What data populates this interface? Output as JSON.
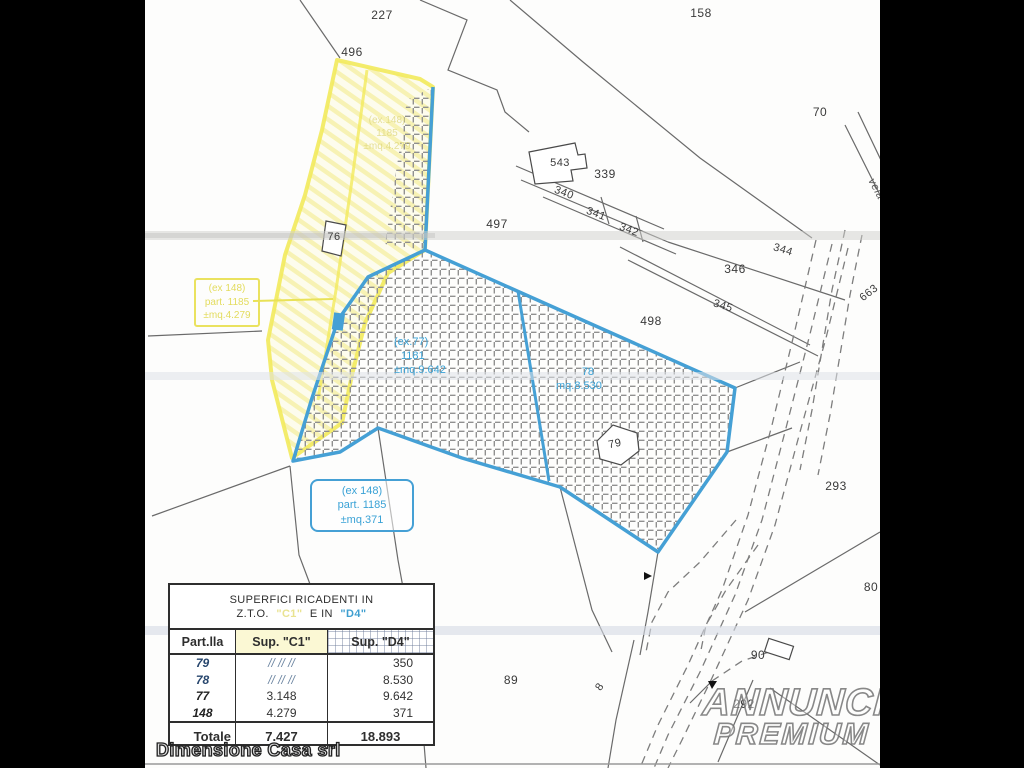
{
  "parcels": {
    "n227": "227",
    "n496": "496",
    "n158": "158",
    "n70": "70",
    "n497": "497",
    "n543": "543",
    "n339": "339",
    "n340": "340",
    "n341": "341",
    "n342": "342",
    "n344": "344",
    "n346": "346",
    "n345": "345",
    "n498": "498",
    "n663": "663",
    "n293": "293",
    "n80": "80",
    "n90": "90",
    "n89": "89",
    "n292": "292",
    "n8": "8",
    "n76": "76",
    "n79": "79",
    "road_name": "vela"
  },
  "annotations": {
    "ex77": {
      "line1": "(ex.77)",
      "line2": "1181",
      "line3": "±mq.9.642"
    },
    "p78": {
      "line1": "78",
      "line2": "mq.8.530"
    },
    "ex148_blue": {
      "line1": "(ex 148)",
      "line2": "part. 1185",
      "line3": "±mq.371"
    },
    "ex148_yellow": {
      "line1": "(ex 148)",
      "line2": "part. 1185",
      "line3": "±mq.4.279"
    },
    "ex148_faint": {
      "line1": "(ex.148)",
      "line2": "1185",
      "line3": "±mq.4.279"
    }
  },
  "table": {
    "title_line1": "SUPERFICI RICADENTI IN",
    "title_zto": "Z.T.O.",
    "title_c1": "\"C1\"",
    "title_ein": "E IN",
    "title_d4": "\"D4\"",
    "headers": [
      "Part.lla",
      "Sup. \"C1\"",
      "Sup. \"D4\""
    ],
    "rows": [
      {
        "part": "79",
        "c1": "//  //  //",
        "d4": "350"
      },
      {
        "part": "78",
        "c1": "//  //  //",
        "d4": "8.530"
      },
      {
        "part": "77",
        "c1": "3.148",
        "d4": "9.642"
      },
      {
        "part": "148",
        "c1": "4.279",
        "d4": "371"
      }
    ],
    "total": {
      "label": "Totale",
      "c1": "7.427",
      "d4": "18.893"
    }
  },
  "footer": {
    "company": "Dimensione Casa srl"
  },
  "watermark": {
    "line1": "ANNUNCI",
    "line2": "PREMIUM"
  },
  "colors": {
    "parcel_blue": "#45a0d5",
    "parcel_yellow": "#f2ea5c",
    "annotation_blue": "#3aa2d6",
    "annotation_yellow": "#e3dc5e",
    "table_c1_bg": "#fbf8d4",
    "table_d4_blue": "#3f9fd0"
  }
}
